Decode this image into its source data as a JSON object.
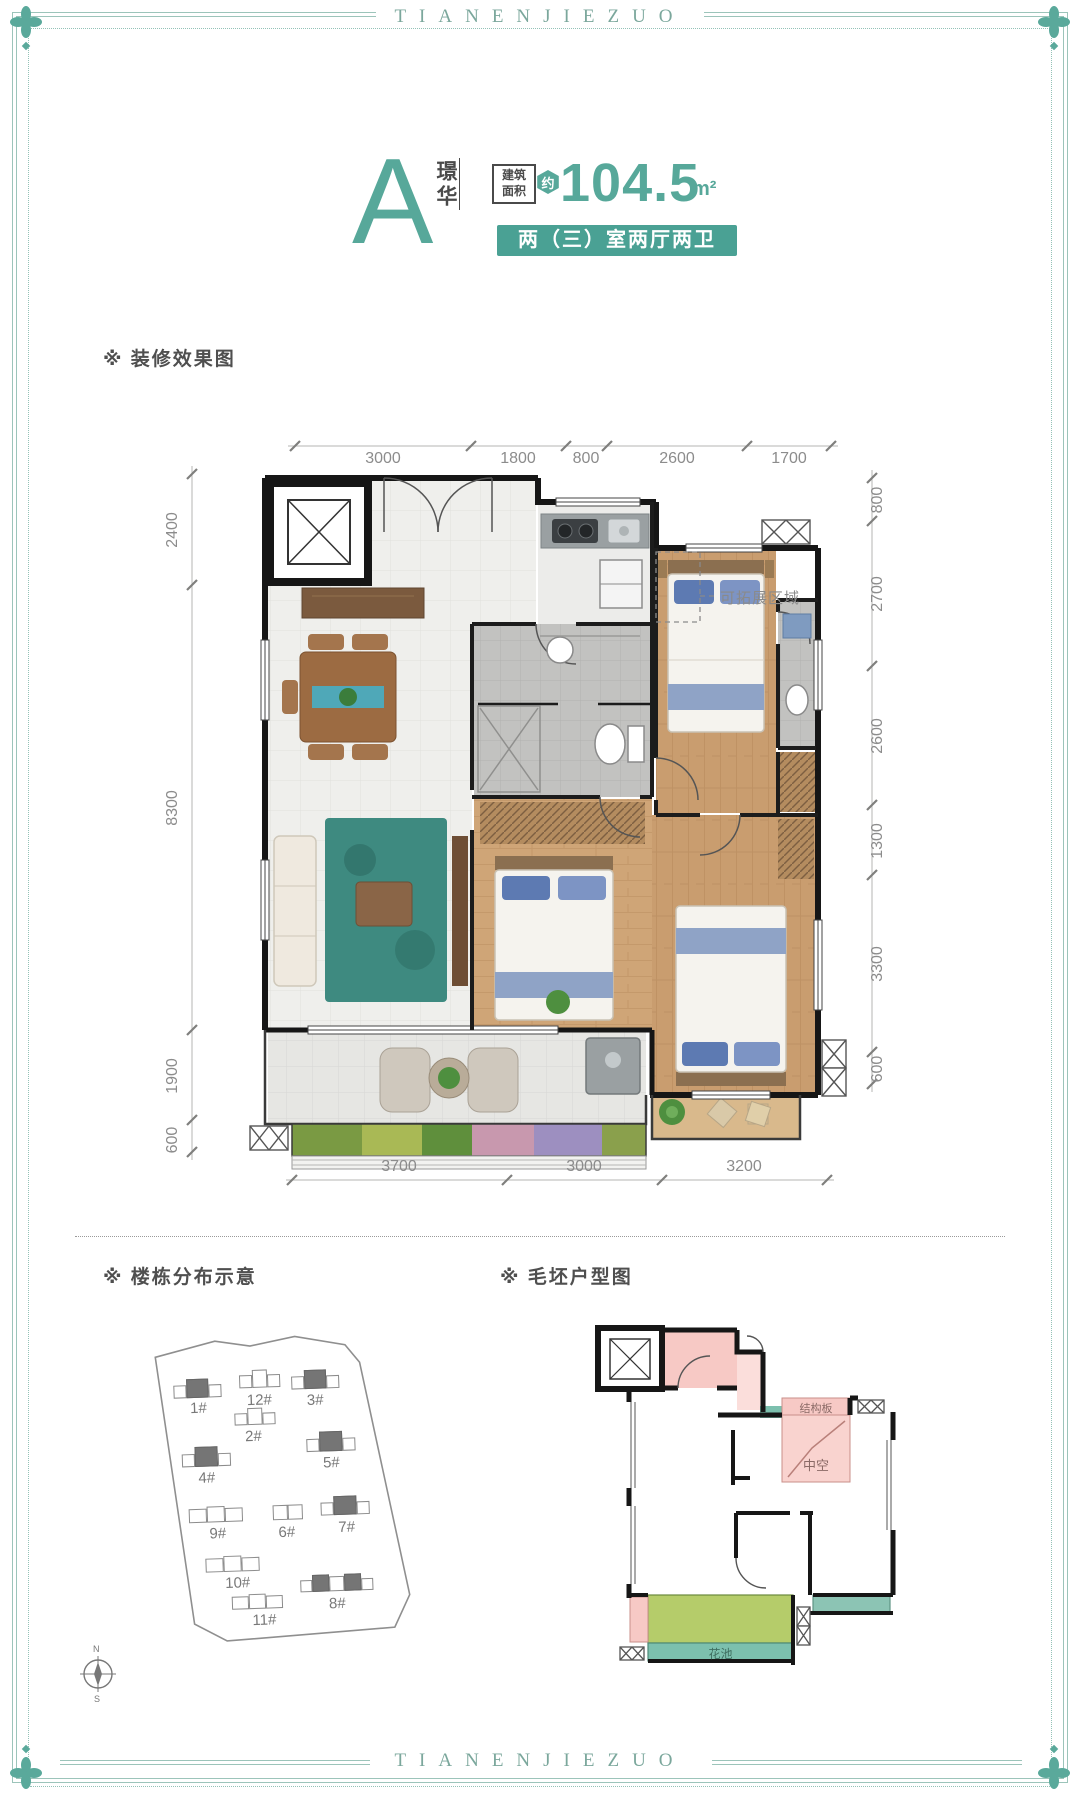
{
  "brand": {
    "top_text": "TIANENJIEZUO",
    "bottom_text": "TIANENJIEZUO"
  },
  "header": {
    "unit_letter": "A",
    "unit_name": "璟华",
    "area_box_line1": "建筑",
    "area_box_line2": "面积",
    "approx": "约",
    "area_value": "104.5",
    "area_unit": "m²",
    "layout_banner": "两（三）室两厅两卫"
  },
  "section_labels": {
    "render": "※ 装修效果图",
    "site": "※ 楼栋分布示意",
    "rough": "※ 毛坯户型图"
  },
  "floorplan": {
    "expand_label": "可拓展区域",
    "dims_top": [
      "3000",
      "1800",
      "800",
      "2600",
      "1700"
    ],
    "dims_left": [
      "2400",
      "8300",
      "1900",
      "600"
    ],
    "dims_right": [
      "800",
      "2700",
      "2600",
      "1300",
      "3300",
      "600"
    ],
    "dims_bottom": [
      "3700",
      "3000",
      "3200"
    ]
  },
  "siteplan": {
    "buildings": [
      {
        "label": "1#"
      },
      {
        "label": "12#"
      },
      {
        "label": "3#"
      },
      {
        "label": "2#"
      },
      {
        "label": "4#"
      },
      {
        "label": "5#"
      },
      {
        "label": "9#"
      },
      {
        "label": "6#"
      },
      {
        "label": "7#"
      },
      {
        "label": "10#"
      },
      {
        "label": "8#"
      },
      {
        "label": "11#"
      }
    ]
  },
  "roughplan": {
    "structure_label": "结构板",
    "void_label": "中空",
    "flowerbed_label": "花池"
  },
  "compass": {
    "north": "N",
    "south": "S"
  },
  "colors": {
    "accent": "#57a89a",
    "banner_bg": "#4aa194",
    "frame": "#9cc4ba",
    "pink": "#f7c9c5",
    "balcony_green": "#b5cc6a",
    "flower_teal": "#7cc0ae"
  }
}
